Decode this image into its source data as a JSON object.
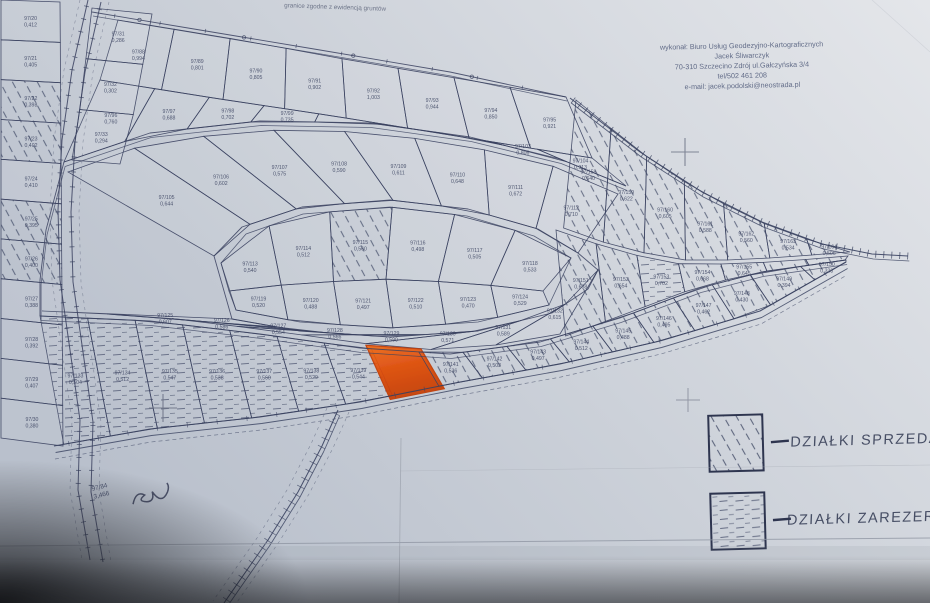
{
  "map": {
    "note": "granice zgodne z ewidencją gruntów",
    "maker": {
      "lines": [
        "wykonał: Biuro Usług Geodezyjno-Kartograficznych",
        "Jacek Śliwarczyk",
        "70-310 Szczecino Zdrój ul.Gałczyńska 3/4",
        "tel/502 461 208",
        "e-mail: jacek.podolski@neostrada.pl"
      ]
    },
    "legend": {
      "sold_label": "DZIAŁKI SPRZEDANE",
      "reserved_label": "DZIAŁKI ZAREZERWOWANE"
    },
    "stream_parcel": {
      "id": "97/84",
      "area": "3,466"
    },
    "colors": {
      "ink": "#39415f",
      "paper": "#ccd1d8",
      "highlight": "#e8500a",
      "highlight_dark": "#c23a05"
    },
    "bands": {
      "t1": [
        {
          "id": "97/88",
          "area": "0,994",
          "status": "plain"
        },
        {
          "id": "97/89",
          "area": "0,801",
          "status": "plain"
        },
        {
          "id": "97/90",
          "area": "0,805",
          "status": "plain"
        },
        {
          "id": "97/91",
          "area": "0,902",
          "status": "plain"
        },
        {
          "id": "97/92",
          "area": "1,003",
          "status": "plain"
        },
        {
          "id": "97/93",
          "area": "0,944",
          "status": "plain"
        },
        {
          "id": "97/94",
          "area": "0,850",
          "status": "plain"
        },
        {
          "id": "97/95",
          "area": "0,921",
          "status": "plain"
        }
      ],
      "t2": [
        {
          "id": "97/96",
          "area": "0,760",
          "status": "plain"
        },
        {
          "id": "97/97",
          "area": "0,688",
          "status": "plain"
        },
        {
          "id": "97/98",
          "area": "0,702",
          "status": "plain"
        },
        {
          "id": "97/99",
          "area": "0,735",
          "status": "plain"
        },
        {
          "id": "97/100",
          "area": "0,810",
          "status": "plain"
        },
        {
          "id": "97/101",
          "area": "0,764",
          "status": "plain"
        },
        {
          "id": "97/102",
          "area": "0,745",
          "status": "plain"
        },
        {
          "id": "97/103",
          "area": "0,806",
          "status": "plain"
        },
        {
          "id": "97/104",
          "area": "0,913",
          "status": "plain"
        }
      ],
      "ringTop": [
        {
          "id": "97/105",
          "area": "0,644",
          "status": "plain"
        },
        {
          "id": "97/106",
          "area": "0,602",
          "status": "plain"
        },
        {
          "id": "97/107",
          "area": "0,575",
          "status": "plain"
        },
        {
          "id": "97/108",
          "area": "0,590",
          "status": "plain"
        },
        {
          "id": "97/109",
          "area": "0,611",
          "status": "plain"
        },
        {
          "id": "97/110",
          "area": "0,648",
          "status": "plain"
        },
        {
          "id": "97/111",
          "area": "0,672",
          "status": "plain"
        },
        {
          "id": "97/112",
          "area": "0,710",
          "status": "plain"
        }
      ],
      "innerTop": [
        {
          "id": "97/113",
          "area": "0,540",
          "status": "plain"
        },
        {
          "id": "97/114",
          "area": "0,512",
          "status": "plain"
        },
        {
          "id": "97/115",
          "area": "0,560",
          "status": "sold"
        },
        {
          "id": "97/116",
          "area": "0,498",
          "status": "plain"
        },
        {
          "id": "97/117",
          "area": "0,505",
          "status": "plain"
        },
        {
          "id": "97/118",
          "area": "0,533",
          "status": "plain"
        }
      ],
      "innerBot": [
        {
          "id": "97/119",
          "area": "0,520",
          "status": "plain"
        },
        {
          "id": "97/120",
          "area": "0,488",
          "status": "plain"
        },
        {
          "id": "97/121",
          "area": "0,497",
          "status": "plain"
        },
        {
          "id": "97/122",
          "area": "0,510",
          "status": "plain"
        },
        {
          "id": "97/123",
          "area": "0,470",
          "status": "plain"
        },
        {
          "id": "97/124",
          "area": "0,529",
          "status": "plain"
        }
      ],
      "ringBot": [
        {
          "id": "97/125",
          "area": "0,607",
          "status": "plain"
        },
        {
          "id": "97/126",
          "area": "0,586",
          "status": "plain"
        },
        {
          "id": "97/127",
          "area": "0,554",
          "status": "plain"
        },
        {
          "id": "97/128",
          "area": "0,566",
          "status": "plain"
        },
        {
          "id": "97/129",
          "area": "0,590",
          "status": "plain"
        },
        {
          "id": "97/130",
          "area": "0,571",
          "status": "plain"
        },
        {
          "id": "97/131",
          "area": "0,589",
          "status": "plain"
        },
        {
          "id": "97/132",
          "area": "0,615",
          "status": "plain"
        }
      ],
      "bl": [
        {
          "id": "97/133",
          "area": "0,504",
          "status": "reserved"
        },
        {
          "id": "97/134",
          "area": "0,512",
          "status": "reserved"
        },
        {
          "id": "97/135",
          "area": "0,547",
          "status": "reserved"
        },
        {
          "id": "97/136",
          "area": "0,538",
          "status": "reserved"
        },
        {
          "id": "97/137",
          "area": "0,560",
          "status": "reserved"
        },
        {
          "id": "97/138",
          "area": "0,529",
          "status": "reserved"
        },
        {
          "id": "97/139",
          "area": "0,544",
          "status": "reserved"
        },
        {
          "id": "97/140",
          "area": "0,568",
          "status": "highlight"
        },
        {
          "id": "97/141",
          "area": "0,536",
          "status": "sold"
        },
        {
          "id": "97/142",
          "area": "0,503",
          "status": "sold"
        },
        {
          "id": "97/143",
          "area": "0,497",
          "status": "sold"
        },
        {
          "id": "97/144",
          "area": "0,512",
          "status": "sold"
        },
        {
          "id": "97/145",
          "area": "0,488",
          "status": "sold"
        },
        {
          "id": "97/146",
          "area": "0,495",
          "status": "sold"
        },
        {
          "id": "97/147",
          "area": "0,462",
          "status": "sold"
        },
        {
          "id": "97/148",
          "area": "0,430",
          "status": "sold"
        },
        {
          "id": "97/149",
          "area": "0,394",
          "status": "sold"
        },
        {
          "id": "97/150",
          "area": "0,338",
          "status": "sold"
        }
      ],
      "rb1": [
        {
          "id": "97/151",
          "area": "0,688",
          "status": "sold"
        },
        {
          "id": "97/152",
          "area": "0,654",
          "status": "sold"
        },
        {
          "id": "97/153",
          "area": "0,702",
          "status": "reserved"
        },
        {
          "id": "97/154",
          "area": "0,668",
          "status": "sold"
        },
        {
          "id": "97/155",
          "area": "0,645",
          "status": "sold"
        },
        {
          "id": "97/156",
          "area": "0,610",
          "status": "sold"
        },
        {
          "id": "97/157",
          "area": "0,586",
          "status": "sold"
        }
      ],
      "rb2": [
        {
          "id": "97/158",
          "area": "0,640",
          "status": "sold"
        },
        {
          "id": "97/159",
          "area": "0,622",
          "status": "sold"
        },
        {
          "id": "97/160",
          "area": "0,605",
          "status": "sold"
        },
        {
          "id": "97/161",
          "area": "0,588",
          "status": "sold"
        },
        {
          "id": "97/162",
          "area": "0,560",
          "status": "sold"
        },
        {
          "id": "97/163",
          "area": "0,534",
          "status": "sold"
        },
        {
          "id": "97/164",
          "area": "0,506",
          "status": "sold"
        }
      ],
      "leftCol": [
        {
          "id": "97/20",
          "area": "0,412",
          "status": "plain"
        },
        {
          "id": "97/21",
          "area": "0,405",
          "status": "plain"
        },
        {
          "id": "97/22",
          "area": "0,398",
          "status": "sold"
        },
        {
          "id": "97/23",
          "area": "0,402",
          "status": "sold"
        },
        {
          "id": "97/24",
          "area": "0,410",
          "status": "plain"
        },
        {
          "id": "97/25",
          "area": "0,395",
          "status": "sold"
        },
        {
          "id": "97/26",
          "area": "0,400",
          "status": "sold"
        },
        {
          "id": "97/27",
          "area": "0,388",
          "status": "plain"
        },
        {
          "id": "97/28",
          "area": "0,392",
          "status": "plain"
        },
        {
          "id": "97/29",
          "area": "0,407",
          "status": "plain"
        },
        {
          "id": "97/30",
          "area": "0,380",
          "status": "plain"
        }
      ],
      "leftQuads": [
        {
          "id": "97/31",
          "area": "0,286",
          "status": "plain"
        },
        {
          "id": "97/32",
          "area": "0,302",
          "status": "plain"
        },
        {
          "id": "97/33",
          "area": "0,294",
          "status": "plain"
        }
      ]
    }
  }
}
